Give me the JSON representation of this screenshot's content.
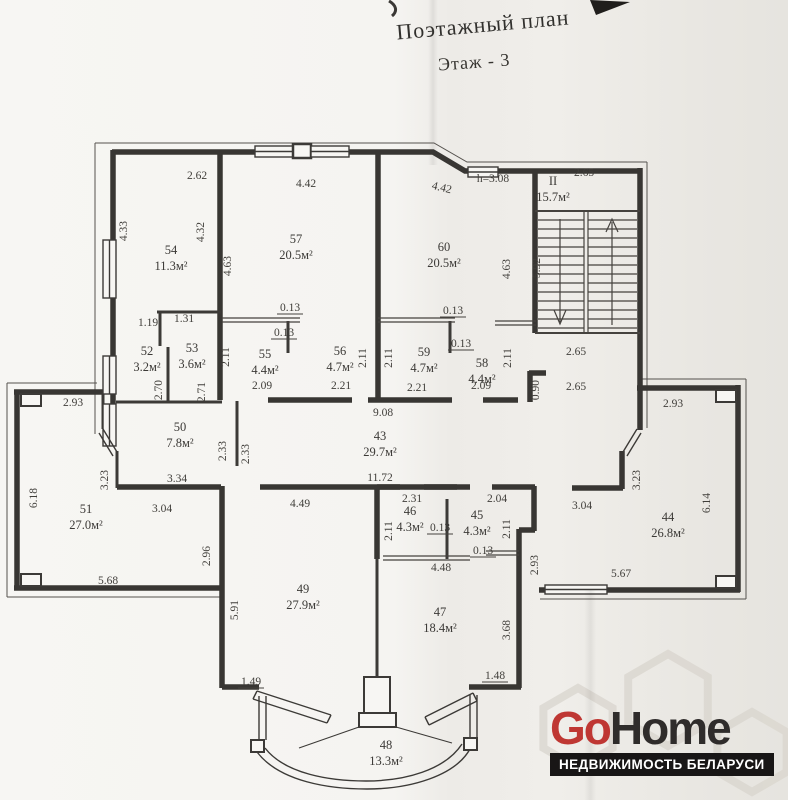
{
  "page": {
    "title_line1": "Поэтажный план",
    "title_line2": "Этаж - 3"
  },
  "plan": {
    "rooms": [
      {
        "number": "54",
        "area": "11.3м²"
      },
      {
        "number": "57",
        "area": "20.5м²"
      },
      {
        "number": "60",
        "area": "20.5м²"
      },
      {
        "number": "II",
        "area": "15.7м²"
      },
      {
        "number": "52",
        "area": "3.2м²"
      },
      {
        "number": "53",
        "area": "3.6м²"
      },
      {
        "number": "55",
        "area": "4.4м²"
      },
      {
        "number": "56",
        "area": "4.7м²"
      },
      {
        "number": "59",
        "area": "4.7м²"
      },
      {
        "number": "58",
        "area": "4.4м²"
      },
      {
        "number": "50",
        "area": "7.8м²"
      },
      {
        "number": "43",
        "area": "29.7м²"
      },
      {
        "number": "51",
        "area": "27.0м²"
      },
      {
        "number": "44",
        "area": "26.8м²"
      },
      {
        "number": "46",
        "area": "4.3м²"
      },
      {
        "number": "45",
        "area": "4.3м²"
      },
      {
        "number": "49",
        "area": "27.9м²"
      },
      {
        "number": "47",
        "area": "18.4м²"
      },
      {
        "number": "48",
        "area": "13.3м²"
      }
    ],
    "dims": [
      "2.62",
      "4.42",
      "4.42",
      "h=3.08",
      "2.65",
      "4.33",
      "4.32",
      "4.63",
      "4.63",
      "-5.92-",
      "1.19",
      "1.31",
      "0.13",
      "0.13",
      "0.13",
      "0.13",
      "2.11",
      "2.11",
      "2.11",
      "2.11",
      "2.70",
      "2.71",
      "2.09",
      "2.21",
      "2.21",
      "2.09",
      "0.90",
      "2.65",
      "2.65",
      "9.08",
      "11.72",
      "2.33",
      "2.33",
      "3.34",
      "3.23",
      "3.04",
      "4.49",
      "2.31",
      "2.04",
      "2.11",
      "2.11",
      "0.13",
      "0.13",
      "4.48",
      "2.93",
      "6.18",
      "5.68",
      "2.93",
      "6.14",
      "5.67",
      "3.23",
      "3.04",
      "2.93",
      "2.96",
      "5.91",
      "1.49",
      "1.48",
      "3.68"
    ]
  },
  "logo": {
    "brand_red": "Go",
    "brand_dark": "Home",
    "tagline": "НЕДВИЖИМОСТЬ БЕЛАРУСИ"
  },
  "colors": {
    "wall": "#3a3835",
    "accent_red": "#bf3733",
    "logo_dark": "#2f2c2b",
    "paper": "#f5f4f1"
  }
}
